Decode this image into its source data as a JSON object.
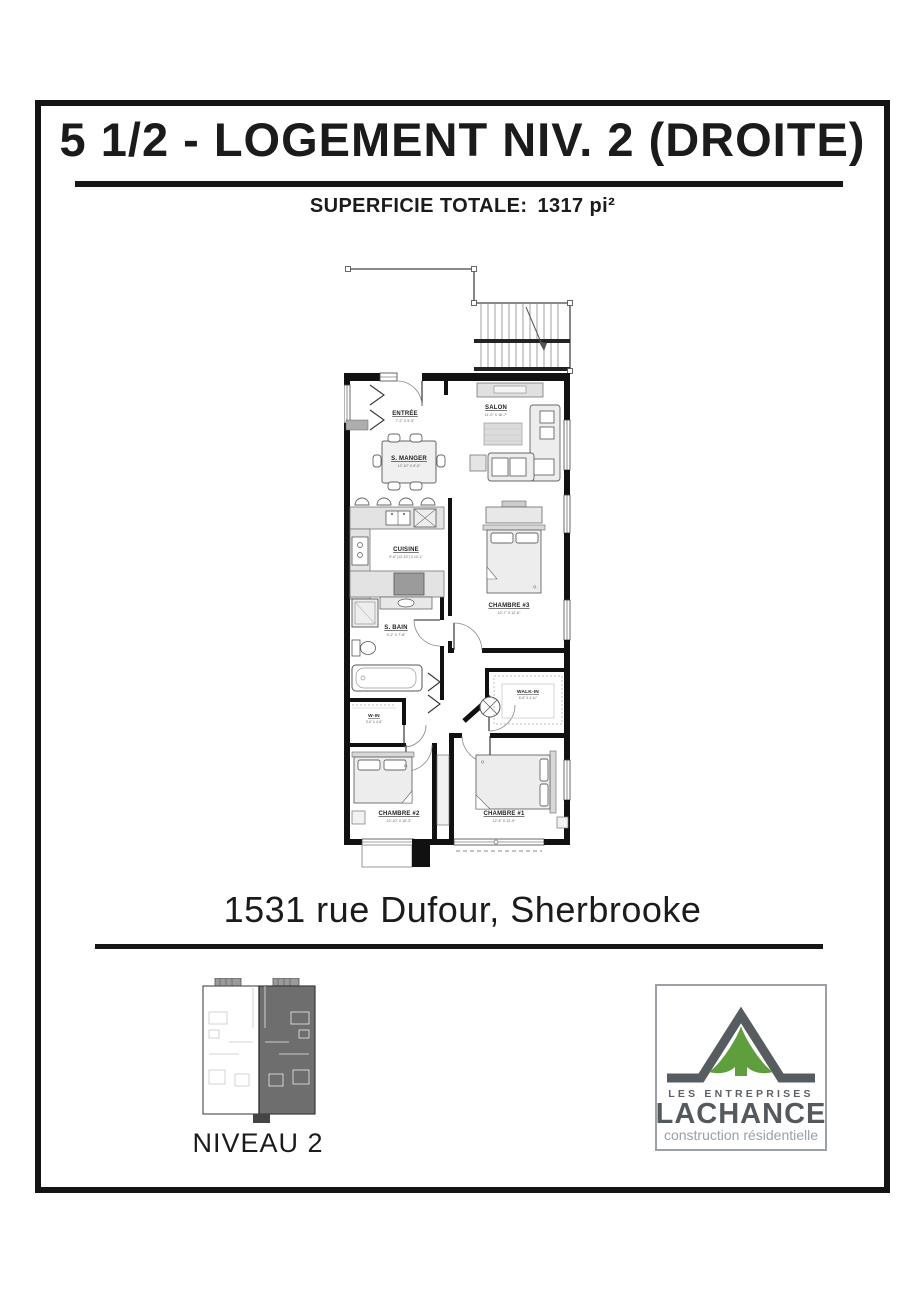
{
  "header": {
    "title": "5 1/2 - LOGEMENT NIV. 2 (DROITE)",
    "superficie_label": "SUPERFICIE TOTALE:",
    "superficie_value": "1317 pi²"
  },
  "floorplan": {
    "bed_tag": "Q.",
    "rooms": [
      {
        "name": "ENTRÉE",
        "dims": "7'-2\" X 5'-5\""
      },
      {
        "name": "SALON",
        "dims": "11'-0\" X 16'-7\""
      },
      {
        "name": "S. MANGER",
        "dims": "12'-10\" X 8'-0\""
      },
      {
        "name": "CUISINE",
        "dims": "9'-6\" (12'-10\") X 10'-1\""
      },
      {
        "name": "S. BAIN",
        "dims": "9'-2\" X 7'-8\""
      },
      {
        "name": "CHAMBRE #3",
        "dims": "10'-7\" X 12'-6\""
      },
      {
        "name": "W-IN",
        "dims": "3'-6\" X 4'-6\""
      },
      {
        "name": "WALK-IN",
        "dims": "6'-6\" X 4'-11\""
      },
      {
        "name": "CHAMBRE #2",
        "dims": "10'-10\" X 10'-3\""
      },
      {
        "name": "CHAMBRE #1",
        "dims": "12'-4\" X 12'-5\""
      }
    ]
  },
  "address": "1531 rue Dufour, Sherbrooke",
  "level": {
    "label": "NIVEAU 2"
  },
  "logo": {
    "line1": "LES ENTREPRISES",
    "line2": "LACHANCE",
    "line3": "construction résidentielle",
    "green": "#5f9e3c",
    "gray": "#565b60"
  }
}
